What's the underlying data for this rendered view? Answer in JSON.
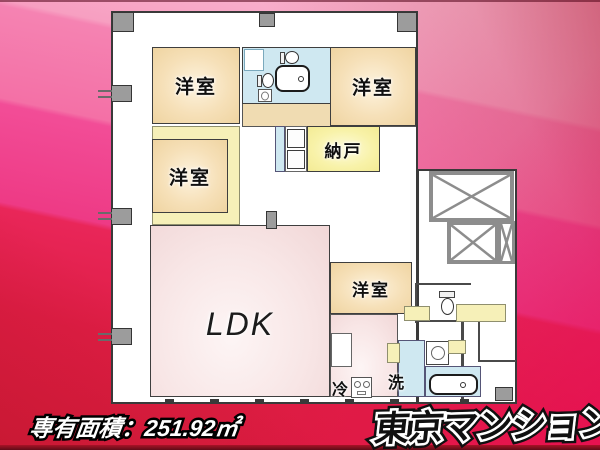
{
  "background": {
    "band_colors": [
      "#fbc2d7",
      "#f470a6",
      "#ee3a85",
      "#d91c3c"
    ],
    "top_right_color": "#c41d3c",
    "bottom_right_color": "#ee1158",
    "bottom_strip_color": "#8c1020"
  },
  "floor_plan": {
    "wall_color": "#3a3a3a",
    "room_fill_colors": {
      "bedroom": "#f2d9a9",
      "storage": "#f7f1a3",
      "ldk": "#f5dfdf",
      "bathroom": "#cfe8f1",
      "closet": "#f6f0b8",
      "corridor": "#ffffff",
      "pillar": "#9c9c9c",
      "elevator_wall": "#8d8d8d"
    },
    "rooms": [
      {
        "id": "bedroom-1",
        "label": "洋室"
      },
      {
        "id": "bedroom-2",
        "label": "洋室"
      },
      {
        "id": "bedroom-3",
        "label": "洋室"
      },
      {
        "id": "storage",
        "label": "納戸"
      },
      {
        "id": "ldk",
        "label": "LDK"
      },
      {
        "id": "bedroom-4",
        "label": "洋室"
      },
      {
        "id": "refrigerator",
        "label": "冷"
      },
      {
        "id": "laundry",
        "label": "洗"
      }
    ],
    "icons": {
      "bathtub": "rounded-rect-outline-with-drain-dot",
      "toilet": "oval-bowl-with-tank",
      "washbasin": "square-with-oval",
      "washing-machine": "square-with-circle",
      "stove": "square-with-two-burners",
      "elevator": "box-with-x-cross",
      "closet-doors": "double-door-panels",
      "pillar": "gray-square"
    }
  },
  "footer": {
    "area_text": "専有面積：251.92㎡"
  },
  "logo": {
    "text": "東京マンション",
    "fill_color": "#101010",
    "outline_color": "#ffffff"
  }
}
